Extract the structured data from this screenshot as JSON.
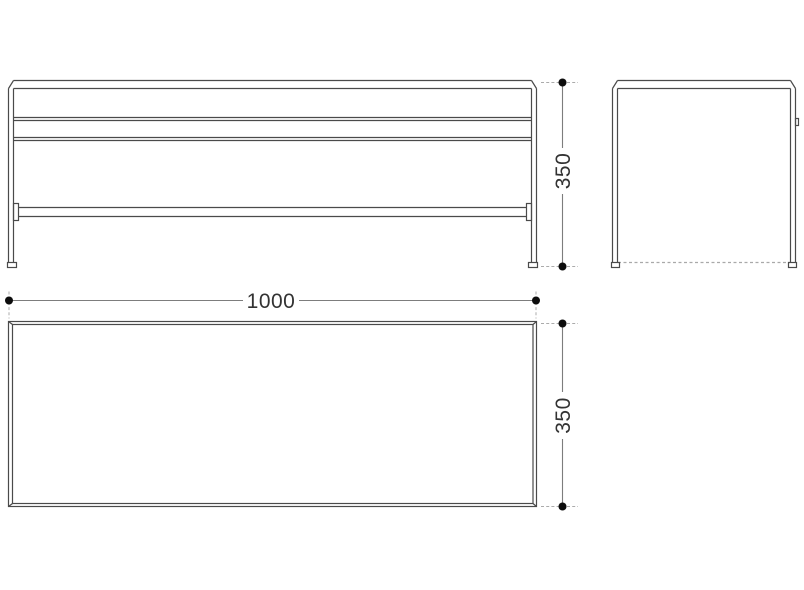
{
  "dimensions": {
    "plan_length": "1000",
    "front_height": "350",
    "plan_depth": "350"
  },
  "colors": {
    "background": "#ffffff",
    "outline": "#4a4a4a",
    "dimension_line": "#7d7d7d",
    "extension_line": "#ababab",
    "dimension_dot": "#0d0d0d",
    "label_text": "#333333"
  }
}
